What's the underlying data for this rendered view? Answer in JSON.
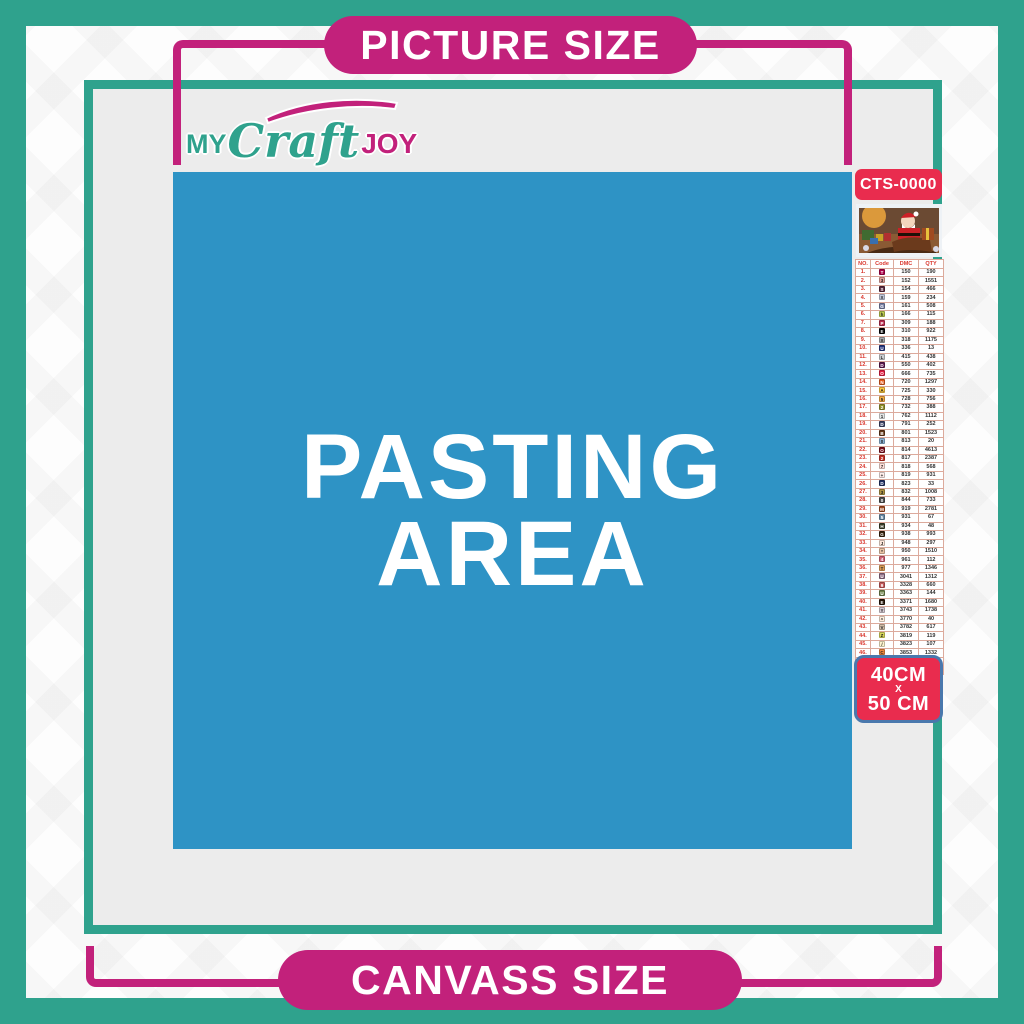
{
  "banner_top": "PICTURE SIZE",
  "banner_bottom": "CANVASS SIZE",
  "brand": {
    "word1": "MY",
    "word2": "Craft",
    "word3": "JOY"
  },
  "pasting": {
    "line1": "PASTING",
    "line2": "AREA"
  },
  "sidebar": {
    "sku": "CTS-0000",
    "size_badge": {
      "line1": "40CM",
      "sep": "X",
      "line2": "50 CM"
    }
  },
  "colors": {
    "teal": "#2fa28d",
    "magenta": "#c2217b",
    "red": "#e92c4e",
    "blue": "#2e93c5",
    "canvas": "#ececec",
    "badge_border": "#4a78ad"
  },
  "chart_data": {
    "type": "table",
    "title": "DMC color legend",
    "headers": [
      "NO.",
      "Code",
      "DMC",
      "QTY"
    ],
    "rows": [
      {
        "no": "1.",
        "sym": "T",
        "hex": "#ab0249",
        "dmc": "150",
        "qty": "190"
      },
      {
        "no": "2.",
        "sym": "3",
        "hex": "#e2a099",
        "dmc": "152",
        "qty": "1551"
      },
      {
        "no": "3.",
        "sym": "S",
        "hex": "#57273b",
        "dmc": "154",
        "qty": "466"
      },
      {
        "no": "4.",
        "sym": "X",
        "hex": "#c3c9dc",
        "dmc": "159",
        "qty": "234"
      },
      {
        "no": "5.",
        "sym": "G",
        "hex": "#7880a4",
        "dmc": "161",
        "qty": "508"
      },
      {
        "no": "6.",
        "sym": "h",
        "hex": "#bdcc51",
        "dmc": "166",
        "qty": "115"
      },
      {
        "no": "7.",
        "sym": "P",
        "hex": "#ba2c4e",
        "dmc": "309",
        "qty": "188"
      },
      {
        "no": "8.",
        "sym": "E",
        "hex": "#000000",
        "dmc": "310",
        "qty": "922"
      },
      {
        "no": "9.",
        "sym": "X",
        "hex": "#a6a8ab",
        "dmc": "318",
        "qty": "1175"
      },
      {
        "no": "10.",
        "sym": "U",
        "hex": "#26357d",
        "dmc": "336",
        "qty": "13"
      },
      {
        "no": "11.",
        "sym": "L",
        "hex": "#cdced1",
        "dmc": "415",
        "qty": "438"
      },
      {
        "no": "12.",
        "sym": "D",
        "hex": "#5c184e",
        "dmc": "550",
        "qty": "402"
      },
      {
        "no": "13.",
        "sym": "O",
        "hex": "#e31d42",
        "dmc": "666",
        "qty": "735"
      },
      {
        "no": "14.",
        "sym": "N",
        "hex": "#e55c1f",
        "dmc": "720",
        "qty": "1297"
      },
      {
        "no": "15.",
        "sym": "A",
        "hex": "#ffc840",
        "dmc": "725",
        "qty": "330"
      },
      {
        "no": "16.",
        "sym": "5",
        "hex": "#f3aa42",
        "dmc": "728",
        "qty": "756"
      },
      {
        "no": "17.",
        "sym": "2",
        "hex": "#94902c",
        "dmc": "732",
        "qty": "388"
      },
      {
        "no": "18.",
        "sym": "1",
        "hex": "#e4e6e6",
        "dmc": "762",
        "qty": "1112"
      },
      {
        "no": "19.",
        "sym": "D",
        "hex": "#3e4467",
        "dmc": "791",
        "qty": "252"
      },
      {
        "no": "20.",
        "sym": "B",
        "hex": "#653919",
        "dmc": "801",
        "qty": "1523"
      },
      {
        "no": "21.",
        "sym": "0",
        "hex": "#8cb3d4",
        "dmc": "813",
        "qty": "20"
      },
      {
        "no": "22.",
        "sym": "O",
        "hex": "#7b0e1b",
        "dmc": "814",
        "qty": "4613"
      },
      {
        "no": "23.",
        "sym": "2",
        "hex": "#c32e23",
        "dmc": "817",
        "qty": "2387"
      },
      {
        "no": "24.",
        "sym": "7",
        "hex": "#ffdfd9",
        "dmc": "818",
        "qty": "568"
      },
      {
        "no": "25.",
        "sym": "+",
        "hex": "#ffeeeb",
        "dmc": "819",
        "qty": "931"
      },
      {
        "no": "26.",
        "sym": "D",
        "hex": "#213063",
        "dmc": "823",
        "qty": "33"
      },
      {
        "no": "27.",
        "sym": "3",
        "hex": "#ad9242",
        "dmc": "832",
        "qty": "1008"
      },
      {
        "no": "28.",
        "sym": "0",
        "hex": "#4c4c4c",
        "dmc": "844",
        "qty": "733"
      },
      {
        "no": "29.",
        "sym": "M",
        "hex": "#a04a20",
        "dmc": "919",
        "qty": "2781"
      },
      {
        "no": "30.",
        "sym": "5",
        "hex": "#6a8aa5",
        "dmc": "931",
        "qty": "67"
      },
      {
        "no": "31.",
        "sym": "H",
        "hex": "#3a3e28",
        "dmc": "934",
        "qty": "48"
      },
      {
        "no": "32.",
        "sym": "G",
        "hex": "#36220c",
        "dmc": "938",
        "qty": "993"
      },
      {
        "no": "33.",
        "sym": "J",
        "hex": "#fee7da",
        "dmc": "948",
        "qty": "297"
      },
      {
        "no": "34.",
        "sym": "*",
        "hex": "#e8c3a4",
        "dmc": "950",
        "qty": "1510"
      },
      {
        "no": "35.",
        "sym": "4",
        "hex": "#cf6275",
        "dmc": "961",
        "qty": "112"
      },
      {
        "no": "36.",
        "sym": "T",
        "hex": "#dc9c56",
        "dmc": "977",
        "qty": "1346"
      },
      {
        "no": "37.",
        "sym": "U",
        "hex": "#8f6d84",
        "dmc": "3041",
        "qty": "1312"
      },
      {
        "no": "38.",
        "sym": "9",
        "hex": "#c45a5a",
        "dmc": "3328",
        "qty": "660"
      },
      {
        "no": "39.",
        "sym": "U",
        "hex": "#72844e",
        "dmc": "3363",
        "qty": "144"
      },
      {
        "no": "40.",
        "sym": "E",
        "hex": "#241508",
        "dmc": "3371",
        "qty": "1680"
      },
      {
        "no": "41.",
        "sym": "Y",
        "hex": "#d7cbd3",
        "dmc": "3743",
        "qty": "1738"
      },
      {
        "no": "42.",
        "sym": "^",
        "hex": "#ffeedd",
        "dmc": "3770",
        "qty": "40"
      },
      {
        "no": "43.",
        "sym": "V",
        "hex": "#d2bca6",
        "dmc": "3782",
        "qty": "617"
      },
      {
        "no": "44.",
        "sym": "Z",
        "hex": "#dbd95c",
        "dmc": "3819",
        "qty": "119"
      },
      {
        "no": "45.",
        "sym": "/",
        "hex": "#fdf4ce",
        "dmc": "3823",
        "qty": "107"
      },
      {
        "no": "46.",
        "sym": "C",
        "hex": "#f0883c",
        "dmc": "3853",
        "qty": "1332"
      },
      {
        "no": "47.",
        "sym": "N",
        "hex": "#82423a",
        "dmc": "3858",
        "qty": "2311"
      },
      {
        "no": "48.",
        "sym": "W",
        "hex": "#a98a69",
        "dmc": "3863",
        "qty": "1820"
      }
    ]
  }
}
